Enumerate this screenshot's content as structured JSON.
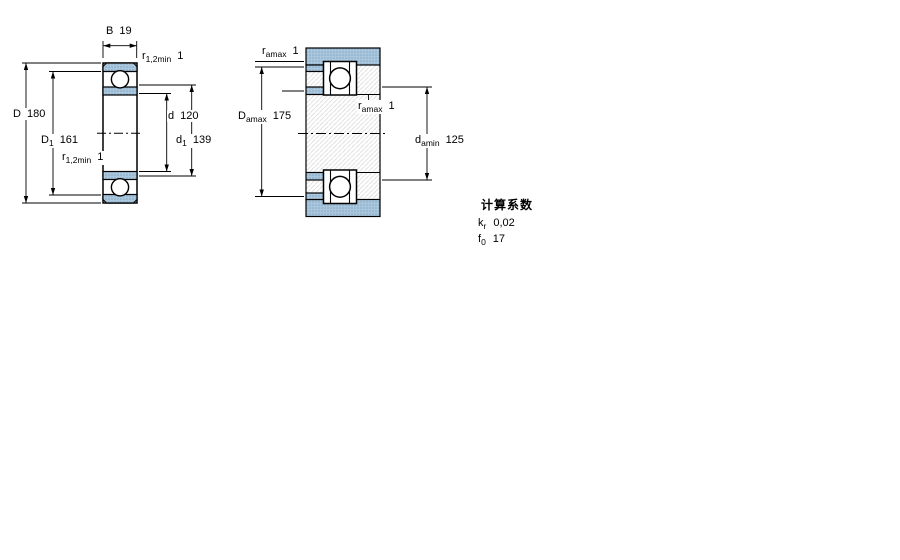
{
  "figure1": {
    "name": "bearing cross-section with boundary dimensions",
    "B": {
      "symbol": "B",
      "value": "19"
    },
    "r12_top": {
      "symbol": "r",
      "subscript": "1,2min",
      "value": "1"
    },
    "D": {
      "symbol": "D",
      "value": "180"
    },
    "D1": {
      "symbol": "D",
      "subscript": "1",
      "value": "161"
    },
    "d": {
      "symbol": "d",
      "value": "120"
    },
    "d1": {
      "symbol": "d",
      "subscript": "1",
      "value": "139"
    },
    "r12_bottom": {
      "symbol": "r",
      "subscript": "1,2min",
      "value": "1"
    }
  },
  "figure2": {
    "name": "abutment and fillet dimensions (mounted bearing)",
    "r_amax_top": {
      "symbol": "r",
      "subscript": "amax",
      "value": "1"
    },
    "D_amax": {
      "symbol": "D",
      "subscript": "amax",
      "value": "175"
    },
    "r_amax_mid": {
      "symbol": "r",
      "subscript": "amax",
      "value": "1"
    },
    "d_amin": {
      "symbol": "d",
      "subscript": "amin",
      "value": "125"
    }
  },
  "calculation_factors": {
    "title": "计算系数",
    "rows": [
      {
        "symbol": "k",
        "subscript": "r",
        "value": "0,02"
      },
      {
        "symbol": "f",
        "subscript": "0",
        "value": "17"
      }
    ]
  },
  "colors": {
    "ring_fill": "#abc7dd",
    "ring_dot": "#7fa6c4",
    "hatch_line": "#e2e2e2",
    "line": "#000000"
  }
}
